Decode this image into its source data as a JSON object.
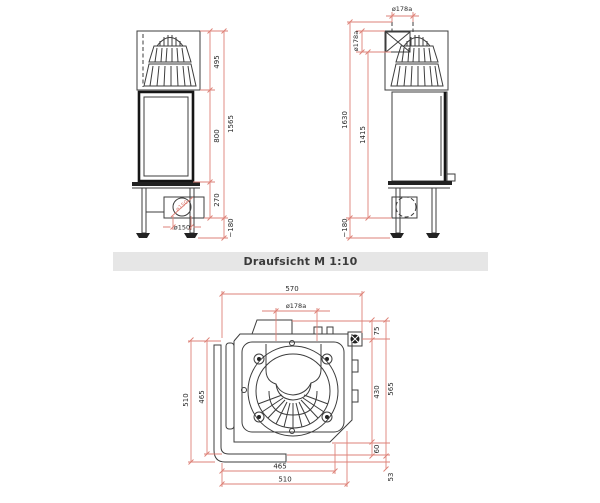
{
  "header": {
    "caption": "Draufsicht M 1:10"
  },
  "colors": {
    "dim-line": "#de8278",
    "drawing-line": "#3d3d3d",
    "dim-text": "#2a2a2a",
    "bar-bg": "#e6e6e6"
  },
  "front_view": {
    "dims": {
      "top_section_height": "495",
      "door_height": "800",
      "base_height": "270",
      "total_height": "1565",
      "feet_adjust": "~180",
      "intake_diameter": "ø150",
      "intake_pipe_diameter": "ø150"
    }
  },
  "side_view": {
    "dims": {
      "flue_diameter_top": "ø178a",
      "flue_diameter_rear": "ø178a",
      "upper_height": "1415",
      "total_height": "1630",
      "feet_adjust": "~180"
    }
  },
  "plan_view": {
    "dims": {
      "overall_width": "570",
      "flue_diameter": "ø178a",
      "flue_rear_offset": "75",
      "body_depth": "430",
      "total_depth": "565",
      "front_offset": "60",
      "frame_depth": "53",
      "left_depth_outer": "510",
      "left_depth_inner": "465",
      "front_width_inner": "465",
      "front_width_outer": "510"
    }
  }
}
